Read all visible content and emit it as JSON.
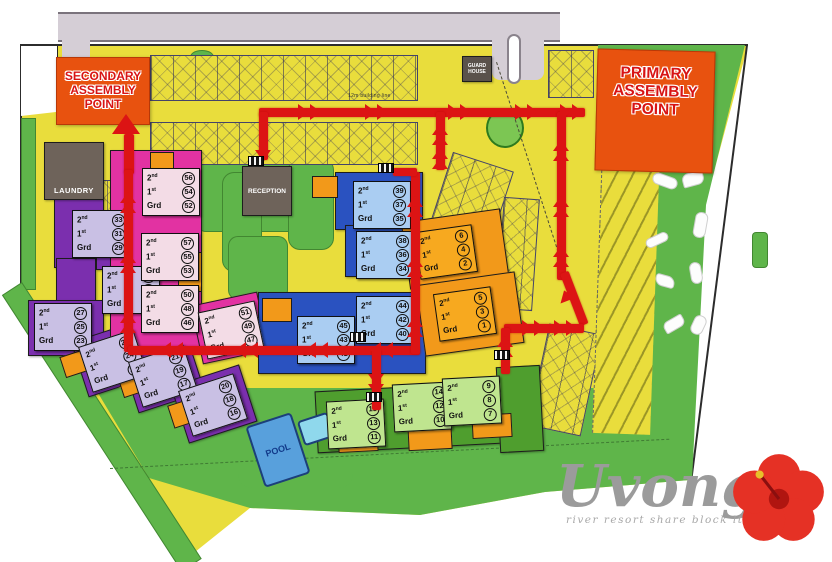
{
  "logo": {
    "name": "Uvongo",
    "tagline": "river resort share block ltd"
  },
  "assembly": {
    "secondary": {
      "lines": [
        "SECONDARY",
        "ASSEMBLY",
        "POINT"
      ]
    },
    "primary": {
      "lines": [
        "PRIMARY",
        "ASSEMBLY",
        "POINT"
      ]
    }
  },
  "facilities": {
    "laundry": "LAUNDRY",
    "reception": "RECEPTION",
    "guard_house": "GUARD HOUSE",
    "pool": "POOL"
  },
  "annotations": {
    "building_line": "12m building line"
  },
  "floor_labels": [
    {
      "base": "2",
      "sup": "nd"
    },
    {
      "base": "1",
      "sup": "st"
    },
    {
      "base": "Grd",
      "sup": ""
    }
  ],
  "units": [
    {
      "group": "purple",
      "second": 33,
      "first": 31,
      "ground": 29
    },
    {
      "group": "purple",
      "second": 32,
      "first": 30,
      "ground": 28
    },
    {
      "group": "purple",
      "second": 27,
      "first": 25,
      "ground": 23
    },
    {
      "group": "purple",
      "second": 26,
      "first": 24,
      "ground": 22
    },
    {
      "group": "purple",
      "second": 21,
      "first": 19,
      "ground": 17
    },
    {
      "group": "purple",
      "second": 20,
      "first": 18,
      "ground": 16
    },
    {
      "group": "pink",
      "second": 56,
      "first": 54,
      "ground": 52
    },
    {
      "group": "pink",
      "second": 57,
      "first": 55,
      "ground": 53
    },
    {
      "group": "pink",
      "second": 50,
      "first": 48,
      "ground": 46
    },
    {
      "group": "pink",
      "second": 51,
      "first": 49,
      "ground": 47
    },
    {
      "group": "blue",
      "second": 39,
      "first": 37,
      "ground": 35
    },
    {
      "group": "blue",
      "second": 38,
      "first": 36,
      "ground": 34
    },
    {
      "group": "blue",
      "second": 45,
      "first": 43,
      "ground": 41
    },
    {
      "group": "blue",
      "second": 44,
      "first": 42,
      "ground": 40
    },
    {
      "group": "orange",
      "second": 6,
      "first": 4,
      "ground": 2
    },
    {
      "group": "orange",
      "second": 5,
      "first": 3,
      "ground": 1
    },
    {
      "group": "green",
      "second": 15,
      "first": 13,
      "ground": 11
    },
    {
      "group": "green",
      "second": 14,
      "first": 12,
      "ground": 10
    },
    {
      "group": "green",
      "second": 9,
      "first": 8,
      "ground": 7
    }
  ],
  "colors": {
    "evac_route": "#dc1414",
    "assembly_bg": "#e8520f",
    "assembly_text": "#d81414",
    "map_yellow": "#e9dd3c",
    "grass_green": "#5fb54a",
    "purple_building": "#7b2fae",
    "purple_label_bg": "#c9c0e4",
    "magenta_building": "#e232a2",
    "pink_label_bg": "#f3dce6",
    "blue_building": "#2a52c0",
    "blue_label_bg": "#aacdf2",
    "orange_building": "#f2991a",
    "orange_label_bg": "#f7a91f",
    "green_building": "#4f9e2e",
    "green_label_bg": "#bfe58f",
    "dark_building": "#6e635a",
    "pool_blue": "#58a0dc",
    "kiddie_pool_blue": "#8fd8ec",
    "road_gray": "#d5ced6"
  }
}
